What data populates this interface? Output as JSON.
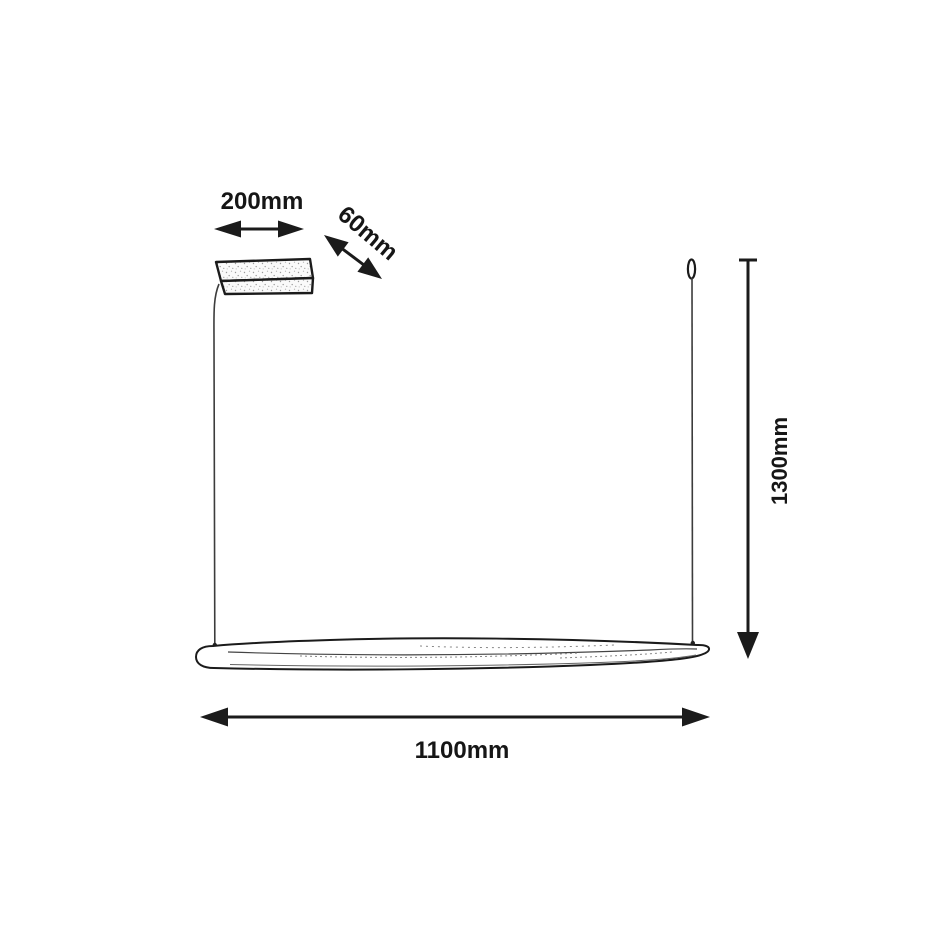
{
  "page": {
    "background": "#ffffff"
  },
  "drawing": {
    "kind": "linear-pendant-lamp-dimension-diagram",
    "line_color": "#1b1b1b",
    "wire_color": "#3c3c3c",
    "text_color": "#161616",
    "labels": {
      "canopy_width": "200mm",
      "canopy_depth": "60mm",
      "suspension_height": "1300mm",
      "fixture_length": "1100mm"
    }
  }
}
